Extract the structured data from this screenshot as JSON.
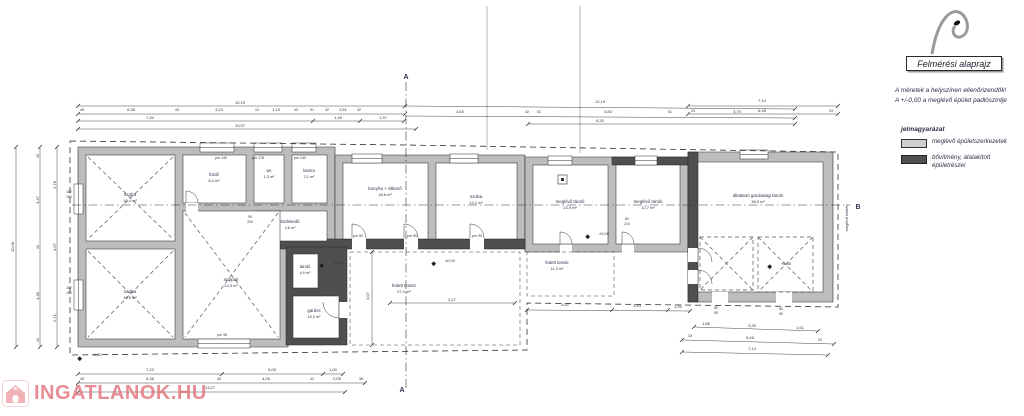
{
  "header": {
    "title": "Felmérési alaprajz",
    "note1": "A méretek a helyszínen ellenőrizendők!",
    "note2": "A +/-0,00 a meglévő épület padlószintje"
  },
  "legend": {
    "heading": "jelmagyarázat",
    "items": [
      {
        "label": "meglévő épületszerkezetek",
        "swatch": "#cfcfcf"
      },
      {
        "label": "bővítmény, átalakított",
        "label2": "épületrészei",
        "swatch": "#4f4f4f"
      }
    ]
  },
  "watermark": {
    "text": "INGATLANOK.HU",
    "color": "#e2737c"
  },
  "colors": {
    "existing_wall": "#bdbdbd",
    "new_wall": "#4f4f4f",
    "line": "#333333",
    "label": "#31314a"
  },
  "plan": {
    "labels": [
      {
        "x": 130,
        "y": 196,
        "t": "szoba",
        "s": 4.6
      },
      {
        "x": 130,
        "y": 202,
        "t": "16,4 m²"
      },
      {
        "x": 130,
        "y": 293,
        "t": "szoba",
        "s": 4.6
      },
      {
        "x": 130,
        "y": 299,
        "t": "16,9 m²"
      },
      {
        "x": 231,
        "y": 281,
        "t": "nappali",
        "s": 4.6
      },
      {
        "x": 231,
        "y": 287,
        "t": "24,3 m²"
      },
      {
        "x": 214,
        "y": 176,
        "t": "fürdő",
        "s": 4.4
      },
      {
        "x": 214,
        "y": 182,
        "t": "5,4 m²"
      },
      {
        "x": 269,
        "y": 172,
        "t": "wc",
        "s": 4.2
      },
      {
        "x": 269,
        "y": 178,
        "t": "1,3 m²",
        "s": 3.8
      },
      {
        "x": 309,
        "y": 172,
        "t": "kamra",
        "s": 4.2
      },
      {
        "x": 309,
        "y": 178,
        "t": "2,1 m²",
        "s": 3.8
      },
      {
        "x": 290,
        "y": 223,
        "t": "közlekedő",
        "s": 4.2
      },
      {
        "x": 290,
        "y": 229,
        "t": "4,6 m²",
        "s": 3.8
      },
      {
        "x": 385,
        "y": 190,
        "t": "konyha + étkező",
        "s": 4.6
      },
      {
        "x": 385,
        "y": 196,
        "t": "18,6 m²"
      },
      {
        "x": 476,
        "y": 198,
        "t": "szoba",
        "s": 4.6
      },
      {
        "x": 476,
        "y": 204,
        "t": "12,1 m²"
      },
      {
        "x": 570,
        "y": 203,
        "t": "meglévő tároló",
        "s": 4.4
      },
      {
        "x": 570,
        "y": 209,
        "t": "13,9 m²"
      },
      {
        "x": 648,
        "y": 203,
        "t": "meglévő tároló",
        "s": 4.4
      },
      {
        "x": 648,
        "y": 209,
        "t": "12,7 m²"
      },
      {
        "x": 758,
        "y": 197,
        "t": "állattartó gazdasági tároló",
        "s": 4.4
      },
      {
        "x": 758,
        "y": 203,
        "t": "38,9 m²"
      },
      {
        "x": 305,
        "y": 268,
        "t": "tároló",
        "s": 4.2
      },
      {
        "x": 305,
        "y": 274,
        "t": "4,9 m²",
        "s": 3.8
      },
      {
        "x": 314,
        "y": 312,
        "t": "garázs",
        "s": 4.4
      },
      {
        "x": 314,
        "y": 318,
        "t": "15,0 m²",
        "s": 3.8
      },
      {
        "x": 404,
        "y": 287,
        "t": "fedett terasz",
        "s": 4.4
      },
      {
        "x": 404,
        "y": 293,
        "t": "27,4 m²"
      },
      {
        "x": 557,
        "y": 264,
        "t": "fedett tornác",
        "s": 4.2
      },
      {
        "x": 557,
        "y": 270,
        "t": "11,2 m²",
        "s": 3.8
      },
      {
        "x": 240,
        "y": 104,
        "t": "10,19"
      },
      {
        "x": 600,
        "y": 103,
        "t": "12,19"
      },
      {
        "x": 82,
        "y": 111,
        "t": "45",
        "s": 3.6
      },
      {
        "x": 131,
        "y": 111,
        "t": "6,38"
      },
      {
        "x": 177,
        "y": 111,
        "t": "43",
        "s": 3.6
      },
      {
        "x": 219,
        "y": 111,
        "t": "3,24"
      },
      {
        "x": 257,
        "y": 111,
        "t": "12",
        "s": 3.6
      },
      {
        "x": 276,
        "y": 111,
        "t": "1,15"
      },
      {
        "x": 296,
        "y": 111,
        "t": "43",
        "s": 3.6
      },
      {
        "x": 312,
        "y": 111,
        "t": "91",
        "s": 3.6
      },
      {
        "x": 327,
        "y": 111,
        "t": "42",
        "s": 3.6
      },
      {
        "x": 343,
        "y": 111,
        "t": "1,51"
      },
      {
        "x": 359,
        "y": 111,
        "t": "42",
        "s": 3.6
      },
      {
        "x": 460,
        "y": 113,
        "t": "3,63"
      },
      {
        "x": 527,
        "y": 113,
        "t": "42",
        "s": 3.6
      },
      {
        "x": 539,
        "y": 113,
        "t": "51",
        "s": 3.6
      },
      {
        "x": 608,
        "y": 113,
        "t": "3,84"
      },
      {
        "x": 670,
        "y": 113,
        "t": "51",
        "s": 3.6
      },
      {
        "x": 737,
        "y": 113,
        "t": "3,79"
      },
      {
        "x": 150,
        "y": 119,
        "t": "7,34"
      },
      {
        "x": 338,
        "y": 119,
        "t": "1,48"
      },
      {
        "x": 383,
        "y": 119,
        "t": "1,37"
      },
      {
        "x": 240,
        "y": 127,
        "t": "10,57"
      },
      {
        "x": 600,
        "y": 122,
        "t": "8,33"
      },
      {
        "x": 762,
        "y": 102,
        "t": "7,14"
      },
      {
        "x": 693,
        "y": 112,
        "t": "23",
        "s": 3.6
      },
      {
        "x": 762,
        "y": 112,
        "t": "6,48"
      },
      {
        "x": 831,
        "y": 112,
        "t": "33",
        "s": 3.6
      },
      {
        "x": 14,
        "y": 247,
        "t": "10,08",
        "r": -90
      },
      {
        "x": 39,
        "y": 156,
        "t": "45",
        "r": -90,
        "s": 3.6
      },
      {
        "x": 39,
        "y": 200,
        "t": "4,47",
        "r": -90
      },
      {
        "x": 39,
        "y": 247,
        "t": "15",
        "r": -90,
        "s": 3.6
      },
      {
        "x": 39,
        "y": 296,
        "t": "4,38",
        "r": -90
      },
      {
        "x": 39,
        "y": 340,
        "t": "43",
        "r": -90,
        "s": 3.6
      },
      {
        "x": 56,
        "y": 185,
        "t": "2,78",
        "r": -90
      },
      {
        "x": 56,
        "y": 247,
        "t": "4,67",
        "r": -90
      },
      {
        "x": 56,
        "y": 318,
        "t": "2,71",
        "r": -90
      },
      {
        "x": 69,
        "y": 193,
        "t": "167",
        "s": 3.4
      },
      {
        "x": 69,
        "y": 198,
        "t": "150",
        "s": 3.4
      },
      {
        "x": 69,
        "y": 289,
        "t": "167",
        "s": 3.4
      },
      {
        "x": 69,
        "y": 294,
        "t": "150",
        "s": 3.4
      },
      {
        "x": 150,
        "y": 371,
        "t": "7,22"
      },
      {
        "x": 272,
        "y": 371,
        "t": "5,05"
      },
      {
        "x": 333,
        "y": 371,
        "t": "1,00"
      },
      {
        "x": 82,
        "y": 380,
        "t": "45",
        "s": 3.6
      },
      {
        "x": 150,
        "y": 380,
        "t": "6,38"
      },
      {
        "x": 219,
        "y": 380,
        "t": "43",
        "s": 3.6
      },
      {
        "x": 266,
        "y": 380,
        "t": "4,26"
      },
      {
        "x": 312,
        "y": 380,
        "t": "42",
        "s": 3.6
      },
      {
        "x": 337,
        "y": 380,
        "t": "2,05"
      },
      {
        "x": 361,
        "y": 380,
        "t": "38",
        "s": 3.6
      },
      {
        "x": 210,
        "y": 389,
        "t": "13,27"
      },
      {
        "x": 97,
        "y": 356,
        "t": "-1,30"
      },
      {
        "x": 706,
        "y": 325,
        "t": "1,88"
      },
      {
        "x": 752,
        "y": 327,
        "t": "3,35"
      },
      {
        "x": 800,
        "y": 329,
        "t": "1,61"
      },
      {
        "x": 690,
        "y": 337,
        "t": "33",
        "s": 3.6
      },
      {
        "x": 750,
        "y": 339,
        "t": "6,48"
      },
      {
        "x": 820,
        "y": 341,
        "t": "33",
        "s": 3.6
      },
      {
        "x": 752,
        "y": 350,
        "t": "7,14"
      },
      {
        "x": 716,
        "y": 309,
        "t": "80",
        "s": 3.4
      },
      {
        "x": 716,
        "y": 314,
        "t": "95",
        "s": 3.4
      },
      {
        "x": 781,
        "y": 310,
        "t": "80",
        "s": 3.4
      },
      {
        "x": 781,
        "y": 315,
        "t": "95",
        "s": 3.4
      },
      {
        "x": 565,
        "y": 306,
        "t": "3,52"
      },
      {
        "x": 637,
        "y": 307,
        "t": "3,43"
      },
      {
        "x": 678,
        "y": 308,
        "t": "1,20"
      },
      {
        "x": 369,
        "y": 296,
        "t": "4,07",
        "r": -90
      },
      {
        "x": 452,
        "y": 301,
        "t": "2,27"
      },
      {
        "x": 250,
        "y": 218,
        "t": "90",
        "s": 3.4
      },
      {
        "x": 250,
        "y": 223,
        "t": "200",
        "s": 3.4
      },
      {
        "x": 627,
        "y": 220,
        "t": "80",
        "s": 3.4
      },
      {
        "x": 627,
        "y": 225,
        "t": "210",
        "s": 3.4
      },
      {
        "x": 221,
        "y": 159,
        "t": "pm 140",
        "s": 3.6
      },
      {
        "x": 258,
        "y": 159,
        "t": "pm 176",
        "s": 3.6
      },
      {
        "x": 300,
        "y": 159,
        "t": "pm 140",
        "s": 3.6
      },
      {
        "x": 358,
        "y": 237,
        "t": "pm 90",
        "s": 3.6
      },
      {
        "x": 412,
        "y": 237,
        "t": "pm 90",
        "s": 3.6
      },
      {
        "x": 477,
        "y": 237,
        "t": "pm 90",
        "s": 3.6
      },
      {
        "x": 222,
        "y": 336,
        "t": "pm 36",
        "s": 3.6
      },
      {
        "x": 338,
        "y": 264,
        "t": "+0,00"
      },
      {
        "x": 450,
        "y": 262,
        "t": "±0,00"
      },
      {
        "x": 604,
        "y": 235,
        "t": "±0,00"
      },
      {
        "x": 786,
        "y": 265,
        "t": "+0,50"
      },
      {
        "x": 406,
        "y": 79,
        "t": "A",
        "s": 7,
        "b": 1
      },
      {
        "x": 402,
        "y": 392,
        "t": "A",
        "s": 7,
        "b": 1
      },
      {
        "x": 858,
        "y": 209,
        "t": "B",
        "s": 7,
        "b": 1
      },
      {
        "x": 848,
        "y": 218,
        "t": "meglévő kerítés",
        "r": -90,
        "s": 3.8
      }
    ]
  }
}
